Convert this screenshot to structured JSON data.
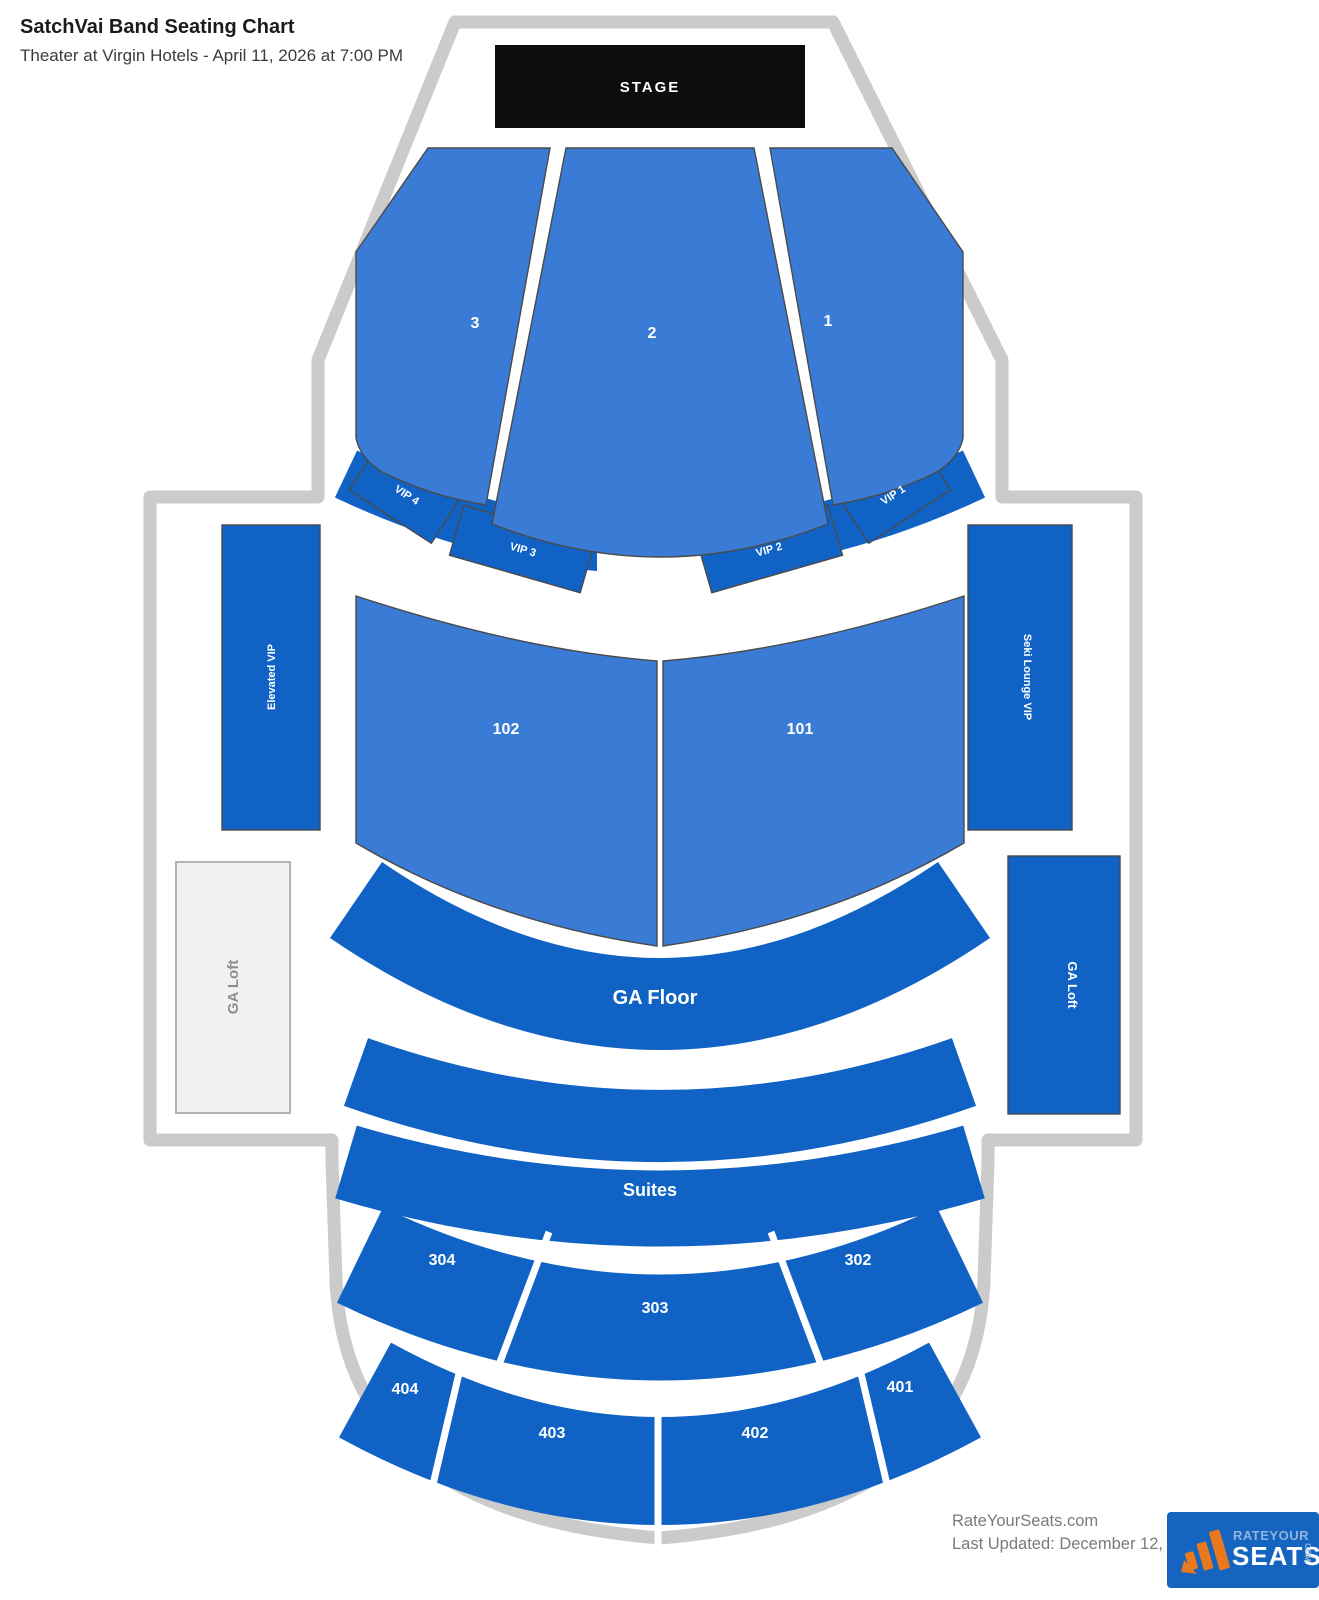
{
  "header": {
    "title": "SatchVai Band Seating Chart",
    "subtitle": "Theater at Virgin Hotels - April 11, 2026 at 7:00 PM"
  },
  "stage_label": "STAGE",
  "sections": {
    "fan3": "3",
    "fan2": "2",
    "fan1": "1",
    "vip4": "VIP 4",
    "vip3": "VIP 3",
    "vip2": "VIP 2",
    "vip1": "VIP 1",
    "s102": "102",
    "s101": "101",
    "ga_floor": "GA Floor",
    "suites": "Suites",
    "s304": "304",
    "s303": "303",
    "s302": "302",
    "s404": "404",
    "s403": "403",
    "s402": "402",
    "s401": "401",
    "elevated_vip": "Elevated VIP",
    "ga_loft_left": "GA Loft",
    "lounge_vip": "Seki Lounge VIP",
    "ga_loft_right": "GA Loft"
  },
  "footer": {
    "site": "RateYourSeats.com",
    "last_updated": "Last Updated: December 12, 2025",
    "logo": {
      "line1": "RATEYOUR",
      "line2": "SEATS",
      "line3": "COM"
    }
  },
  "colors": {
    "section_light_blue": "#3a7cd5",
    "section_dark_blue": "#1063c5",
    "stage_black": "#0d0d0d",
    "outline_gray": "#cbcbcb",
    "loft_gray_fill": "#f1f1f1",
    "logo_blue": "#1565c0",
    "logo_orange": "#e8791e"
  }
}
